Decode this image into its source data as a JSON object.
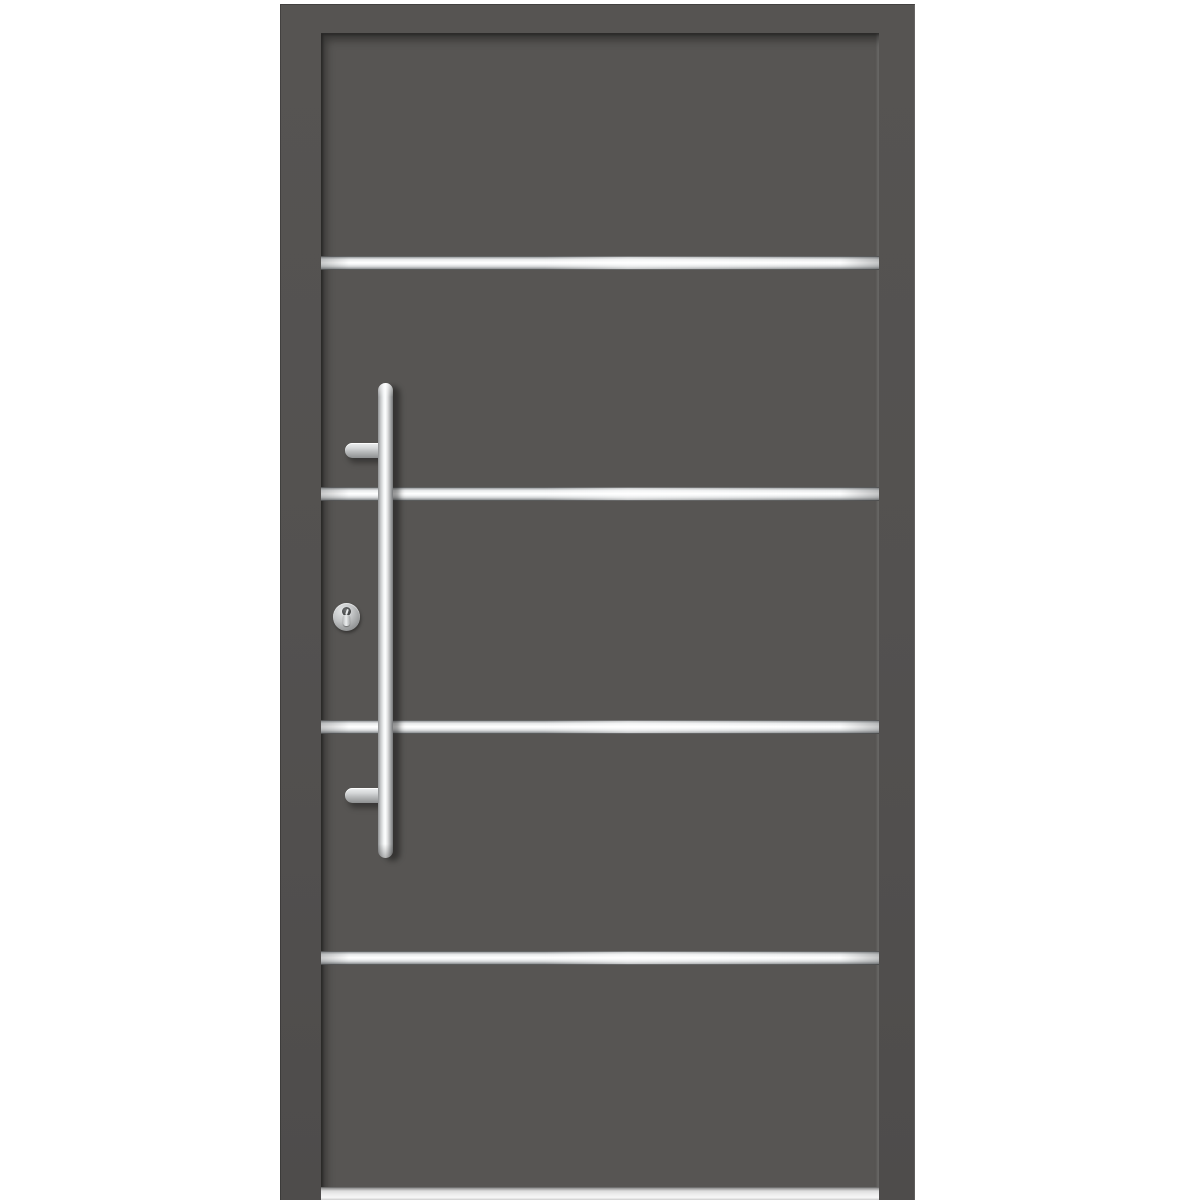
{
  "scene": {
    "type": "product-photo",
    "subject": "modern-front-entry-door",
    "orientation": "front-view",
    "visible_text": ""
  },
  "colors": {
    "background": "#ffffff",
    "door_frame": "#535150",
    "door_panel": "#575553",
    "steel": "#eef0f1",
    "steel_shade": "#989b9d",
    "threshold": "#efefef"
  },
  "door": {
    "finish_name": "anthracite-gray",
    "decor_strips": {
      "count": 4,
      "material": "stainless-steel",
      "positions_y_px": [
        256,
        487,
        720,
        951
      ]
    },
    "hardware": {
      "handle": {
        "type": "vertical-bar-pull-handle",
        "material": "stainless-steel",
        "mounts": 2
      },
      "lock": {
        "type": "euro-profile-cylinder-with-round-escutcheon"
      }
    },
    "threshold": {
      "type": "aluminum-sill"
    }
  }
}
